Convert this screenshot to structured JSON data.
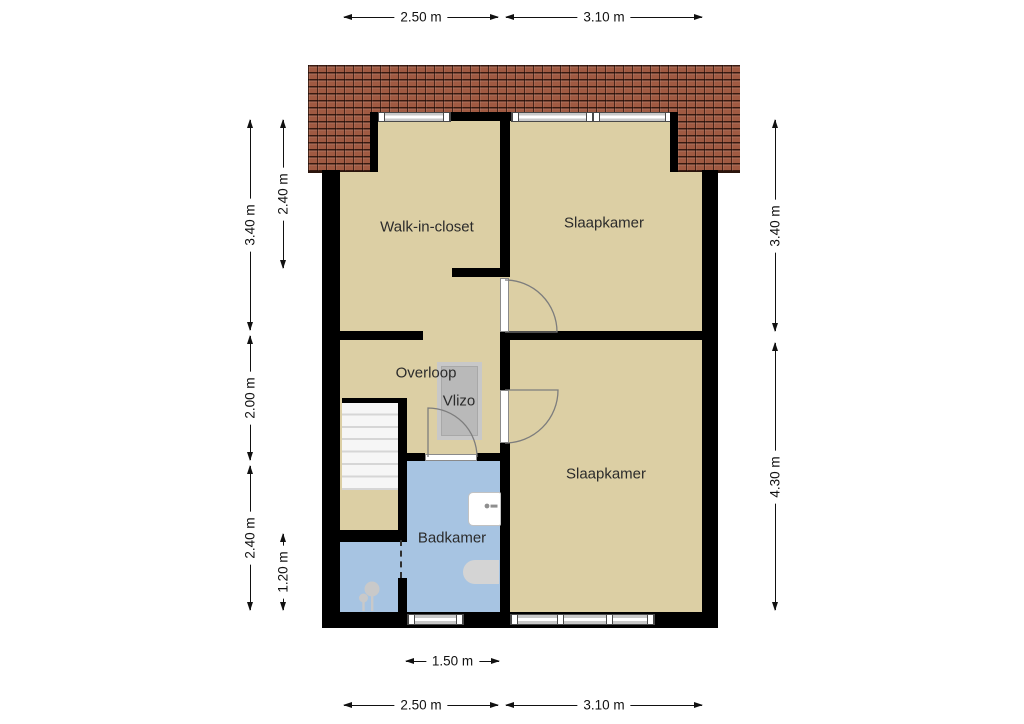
{
  "plan": {
    "rooms": {
      "walk_in_closet": "Walk-in-closet",
      "bedroom_top": "Slaapkamer",
      "bedroom_bottom": "Slaapkamer",
      "landing": "Overloop",
      "attic_hatch": "Vlizo",
      "bathroom": "Badkamer"
    },
    "dimensions": {
      "top": [
        "2.50 m",
        "3.10 m"
      ],
      "bottom_inner": [
        "1.50 m"
      ],
      "bottom": [
        "2.50 m",
        "3.10 m"
      ],
      "left_outer": [
        "3.40 m",
        "2.00 m",
        "2.40 m"
      ],
      "left_inner": [
        "2.40 m",
        "1.20 m"
      ],
      "right": [
        "3.40 m",
        "4.30 m"
      ]
    },
    "colors": {
      "room_floor": "#dccfa4",
      "bathroom_floor": "#a7c4e2",
      "wall": "#000000",
      "roof_tile": "#a05a42"
    }
  }
}
